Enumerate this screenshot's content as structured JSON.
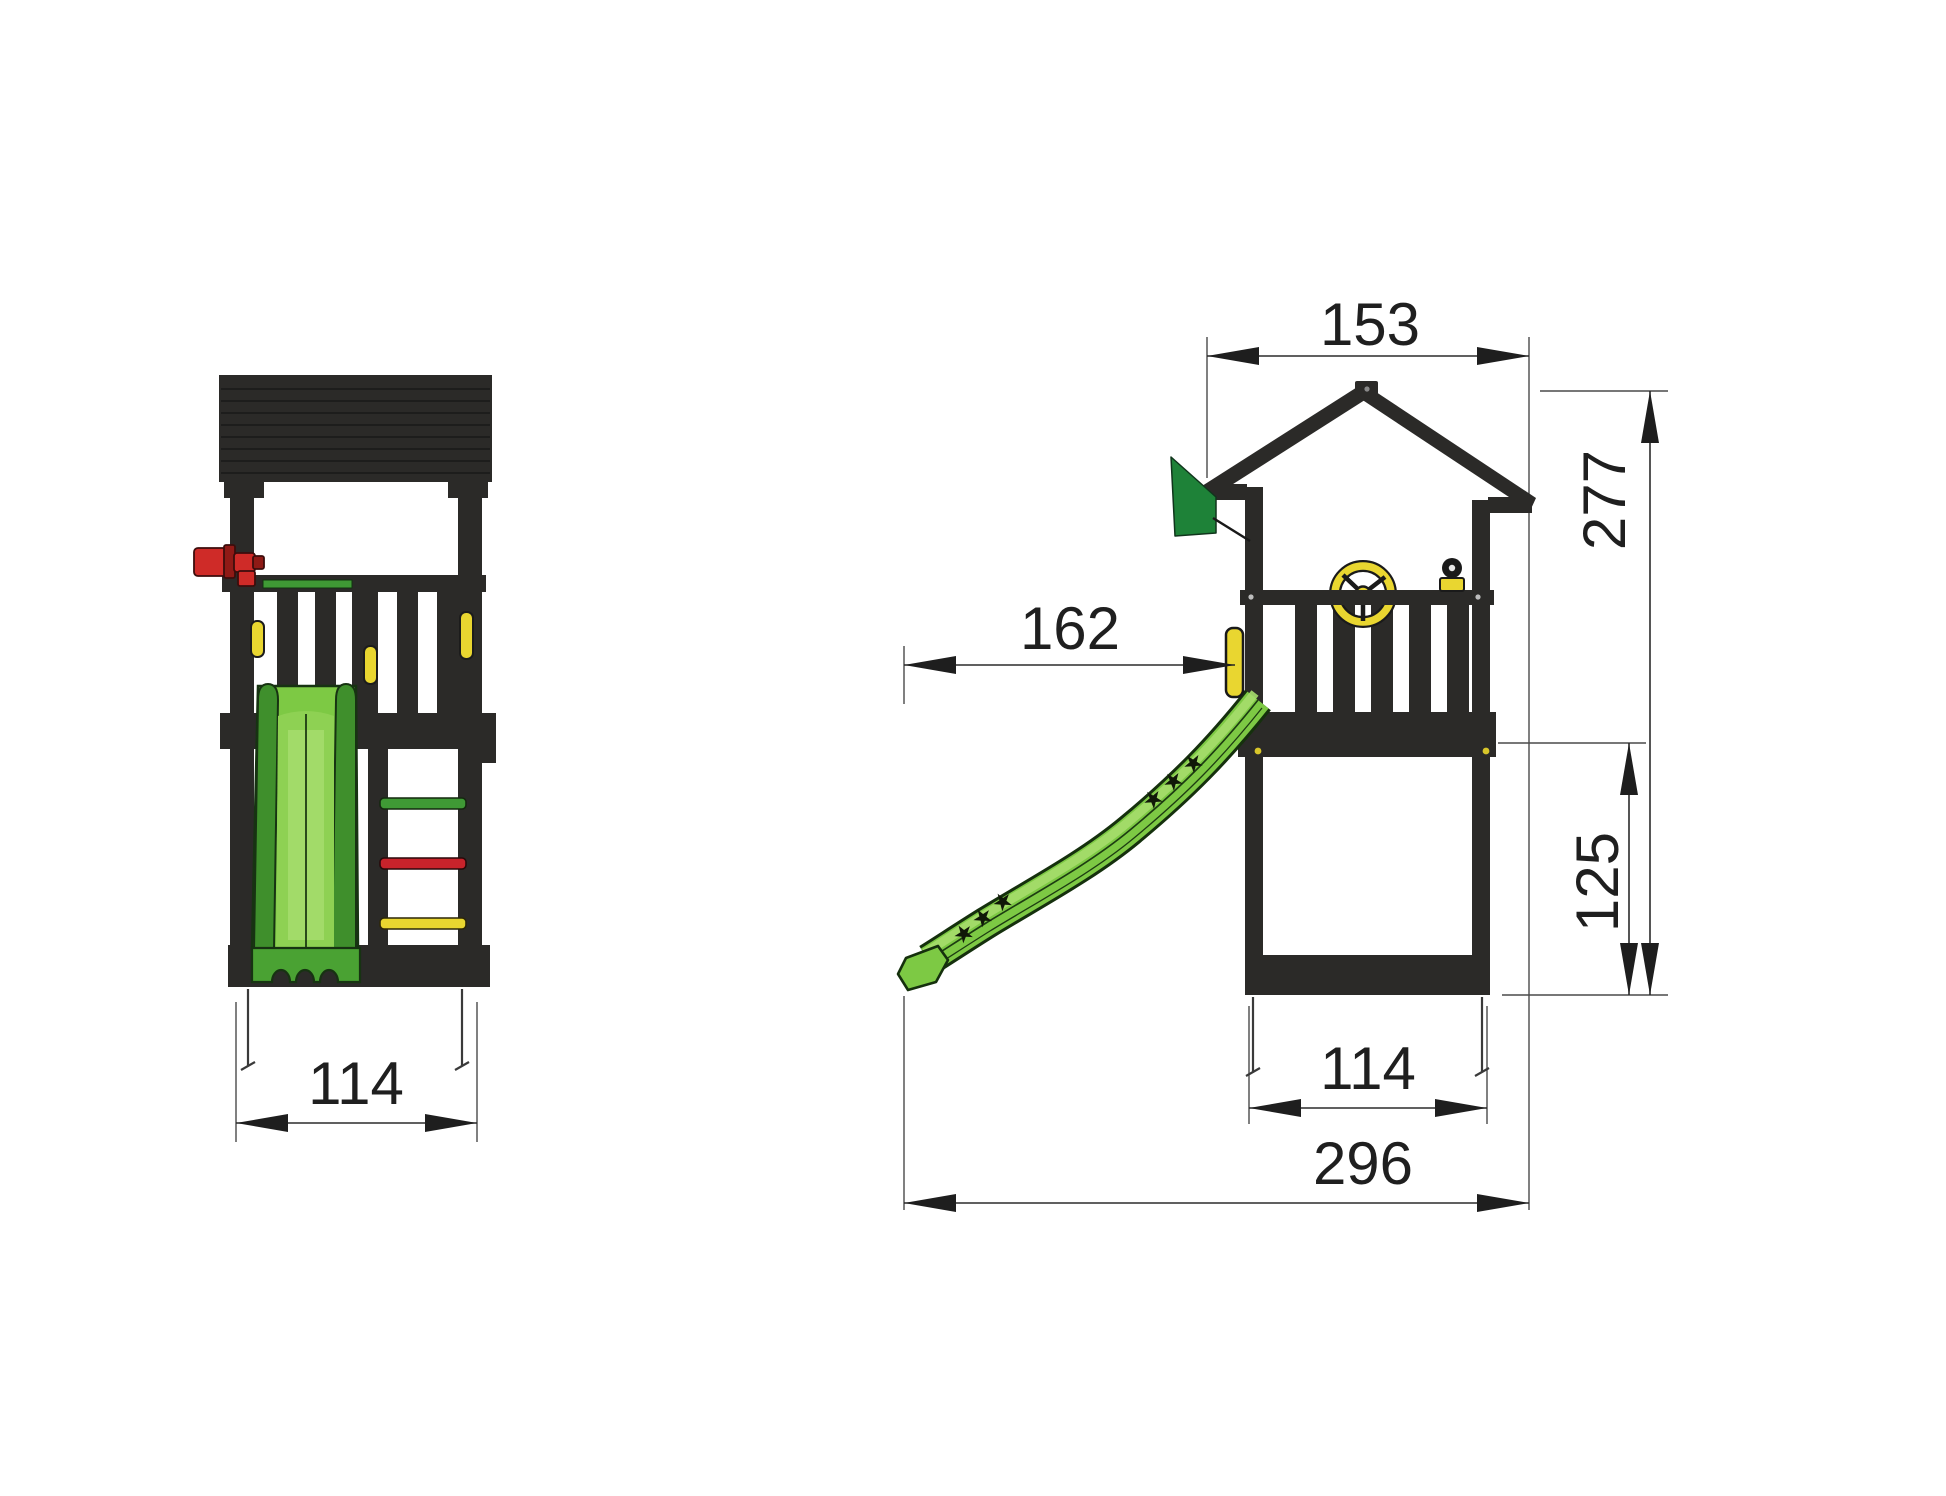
{
  "drawing": {
    "front_view": {
      "name": "playtower front view",
      "dim_base_width": "114"
    },
    "side_view": {
      "name": "playtower side view",
      "dim_roof_width": "153",
      "dim_total_height": "277",
      "dim_slide_reach": "162",
      "dim_platform_height": "125",
      "dim_base_width": "114",
      "dim_total_length": "296"
    }
  },
  "icons": {
    "star_glyph": "★"
  },
  "colors": {
    "structure": "#2b2a28",
    "slide_green": "#7dc944",
    "slide_green_light": "#a6dd6d",
    "slide_green_mid": "#8ed153",
    "slide_green_dark": "#4aa233",
    "slide_rail_dark": "#3f8f2c",
    "slide_outline": "#173312",
    "flag_green": "#1e8238",
    "telescope_red": "#cf2b28",
    "telescope_red_dark": "#8f1a16",
    "rung_green": "#3f9a35",
    "rung_red": "#c8232b",
    "accent_yellow": "#e9d630",
    "dimension_text": "#1f1f1f"
  }
}
